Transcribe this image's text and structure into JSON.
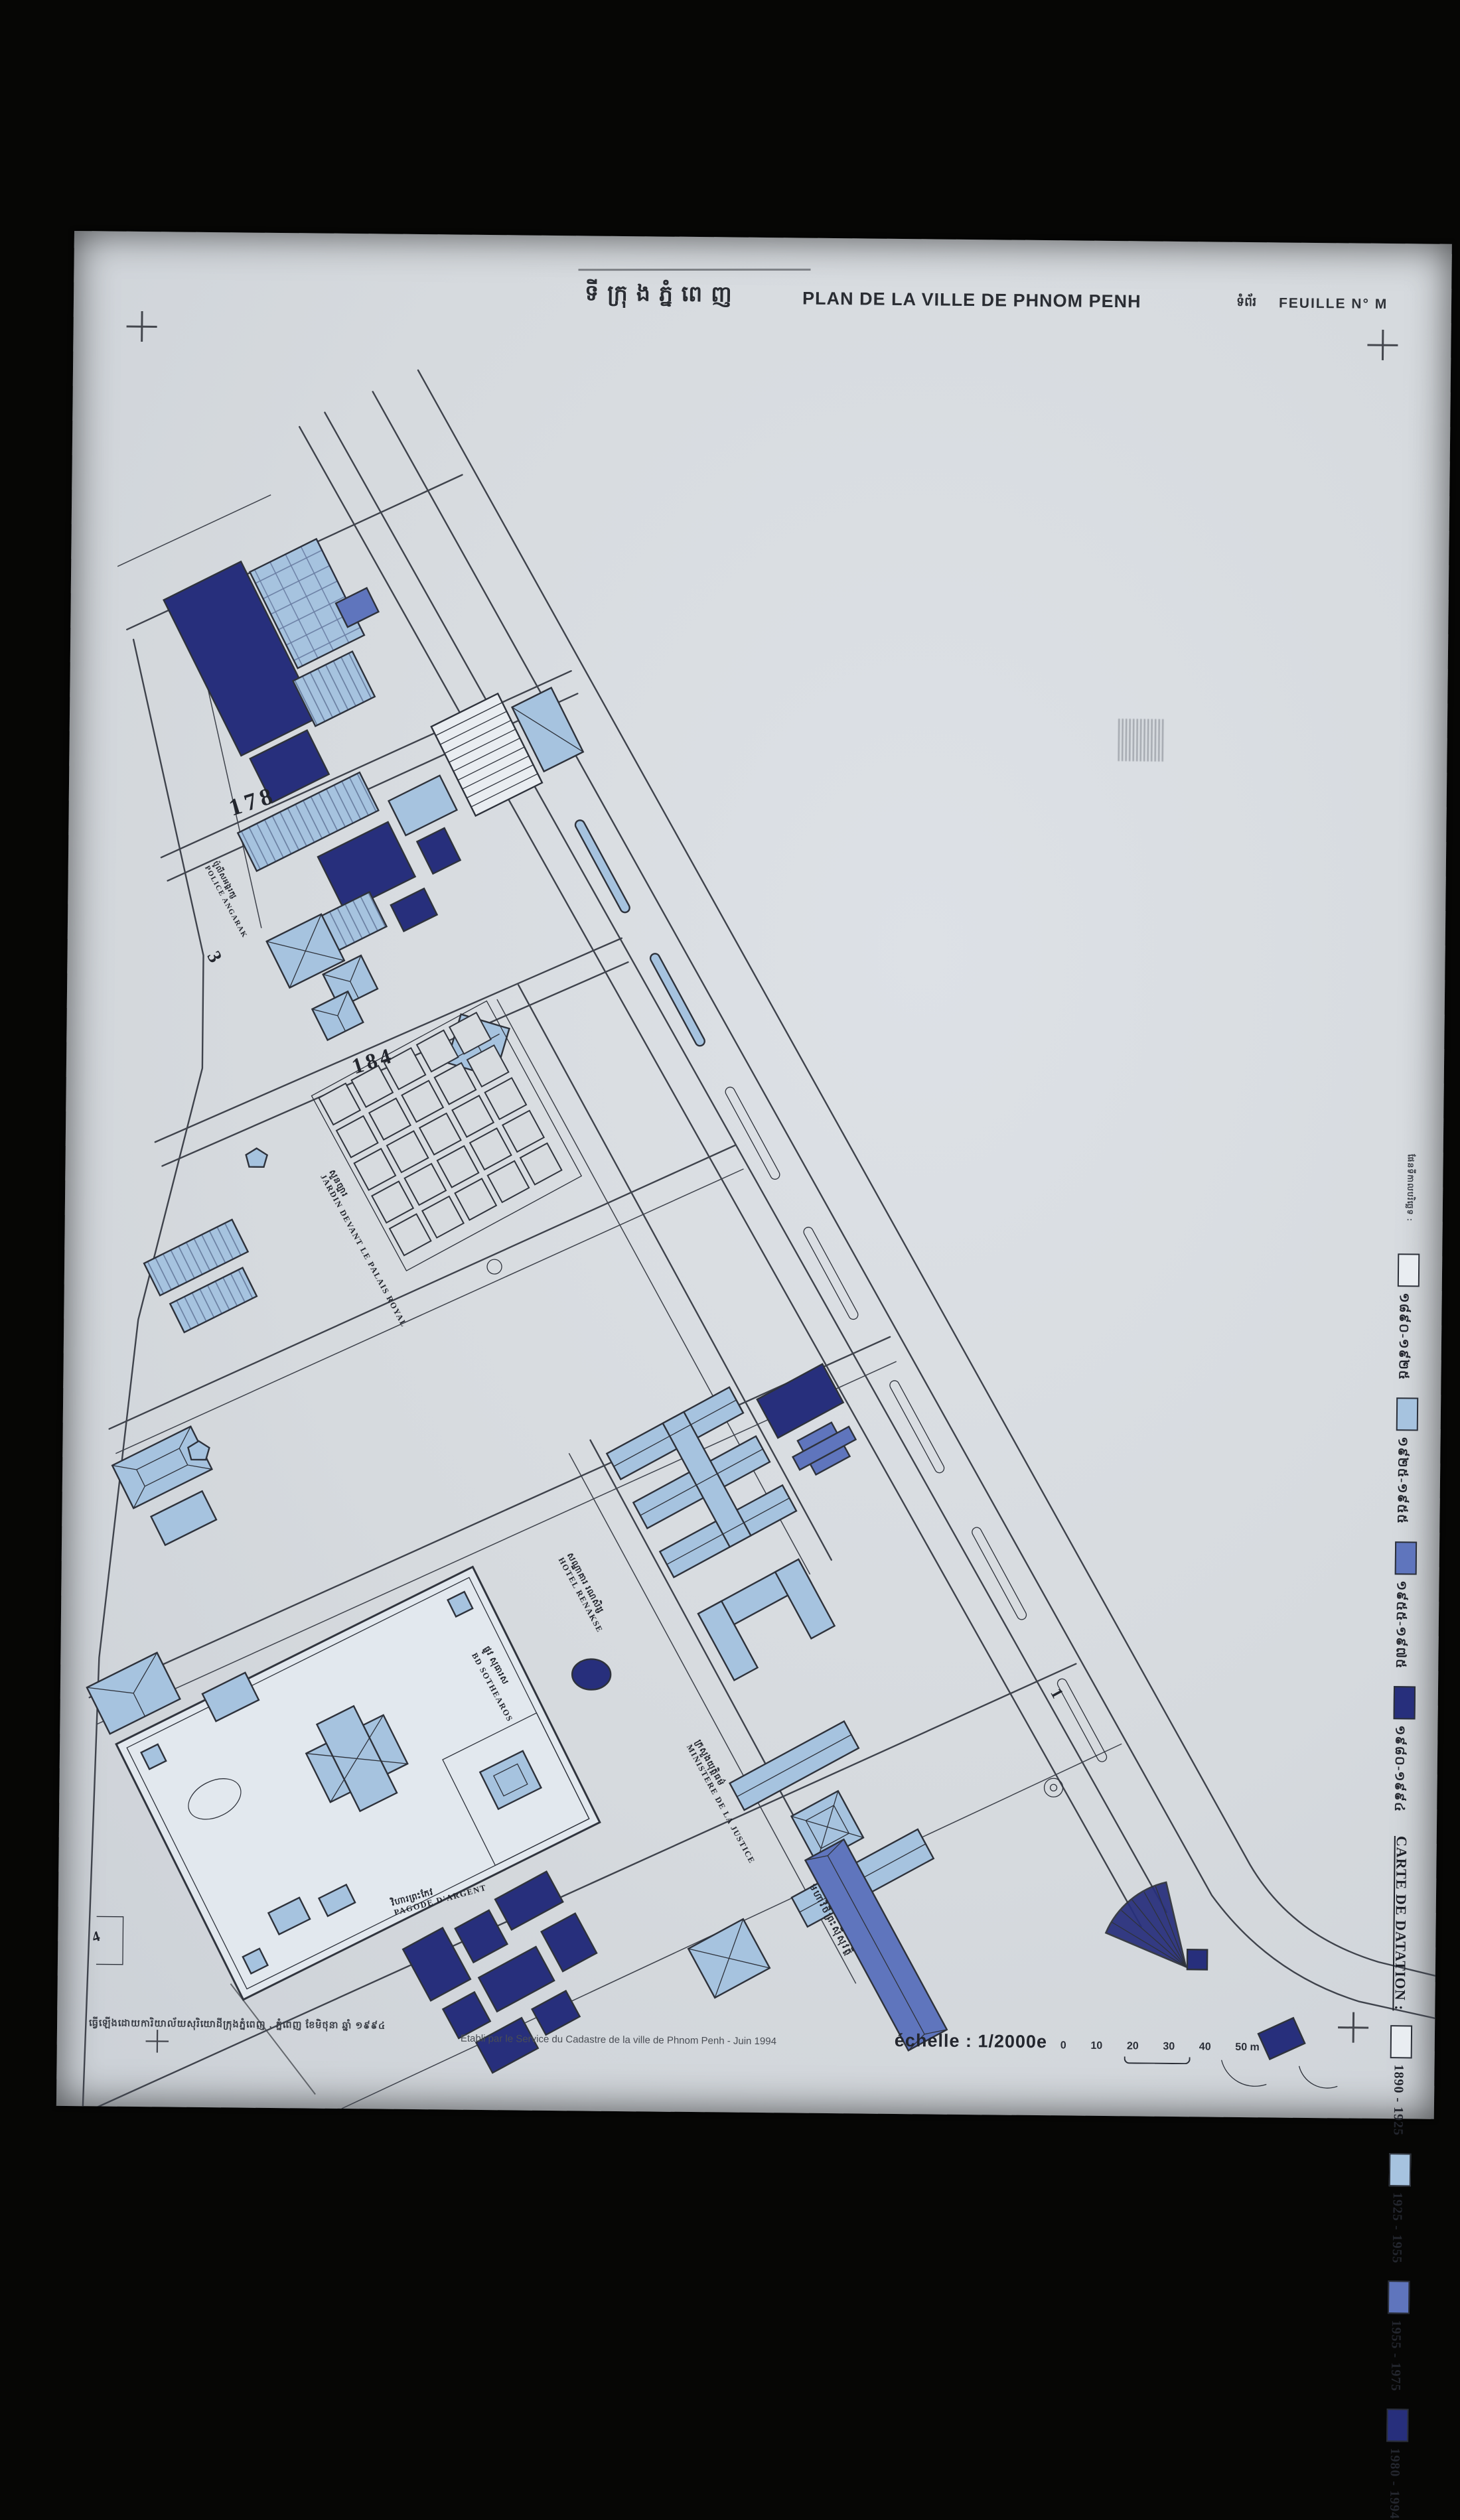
{
  "header": {
    "title_khmer": "ទីក្រុងភ្នំពេញ",
    "title_fr": "PLAN DE LA VILLE DE PHNOM PENH",
    "sheet_khmer": "ទំព័រ",
    "sheet_fr": "FEUILLE N° M"
  },
  "legend": {
    "title_khmer": "ផែនទីកាលបរិច្ឆេទ :",
    "title_fr": "CARTE DE DATATION :",
    "khmer_items": [
      {
        "range": "១៨៩០-១៩២៥",
        "color": "#e9edf1"
      },
      {
        "range": "១៩២៥-១៩៥៥",
        "color": "#a6c3df"
      },
      {
        "range": "១៩៥៥-១៩៧៥",
        "color": "#5f75bd"
      },
      {
        "range": "១៩៨០-១៩៩៤",
        "color": "#272f7c"
      }
    ],
    "items": [
      {
        "range": "1890 - 1925",
        "color": "#e9edf1"
      },
      {
        "range": "1925 - 1955",
        "color": "#a6c3df"
      },
      {
        "range": "1955 - 1975",
        "color": "#5f75bd"
      },
      {
        "range": "1980 - 1994",
        "color": "#272f7c"
      }
    ]
  },
  "map": {
    "street_numbers": [
      "178",
      "184",
      "3",
      "1",
      "4"
    ],
    "labels": {
      "jardin": {
        "khmer": "សួនច្បារ",
        "latin": "JARDIN DEVANT LE PALAIS ROYAL"
      },
      "renakse": {
        "khmer": "សណ្ឋាគារ រណសិរ្ស",
        "latin": "HOTEL RENAKSE"
      },
      "justice": {
        "khmer": "ក្រសួងយុត្តិធម៌",
        "latin": "MINISTERE DE LA JUSTICE"
      },
      "pagode": {
        "khmer": "វិហារព្រះកែវ",
        "latin": "PAGODE D'ARGENT"
      },
      "police": {
        "khmer": "ប៉ូលីសអង្គរក្ស",
        "latin": "POLICE ANGARAK"
      },
      "sothearos": {
        "khmer": "ផ្លូវ សុធារស",
        "latin": "BD SOTHEAROS"
      },
      "quai_khmer": {
        "khmer": "មហាវិថីព្រះស៊ីសុវត្ថិ",
        "latin": ""
      }
    }
  },
  "footer": {
    "attribution_khmer": "ធ្វើឡើងដោយការិយាល័យសុរិយោដីក្រុងភ្នំពេញ . ភ្នំពេញ ខែមិថុនា ឆ្នាំ ១៩៩៤",
    "attribution_fr": "Etabli par le Service du Cadastre de la ville de Phnom Penh - Juin 1994",
    "scale_label": "échelle : 1/2000e",
    "scale_ticks": [
      "0",
      "10",
      "20",
      "30",
      "40",
      "50 m"
    ]
  },
  "colors": {
    "mapline": "#3f434c",
    "c1890": "#e9edf1",
    "c1925": "#a6c3df",
    "c1955": "#5f75bd",
    "c1980": "#272f7c",
    "paper": "#d7dbdf"
  }
}
